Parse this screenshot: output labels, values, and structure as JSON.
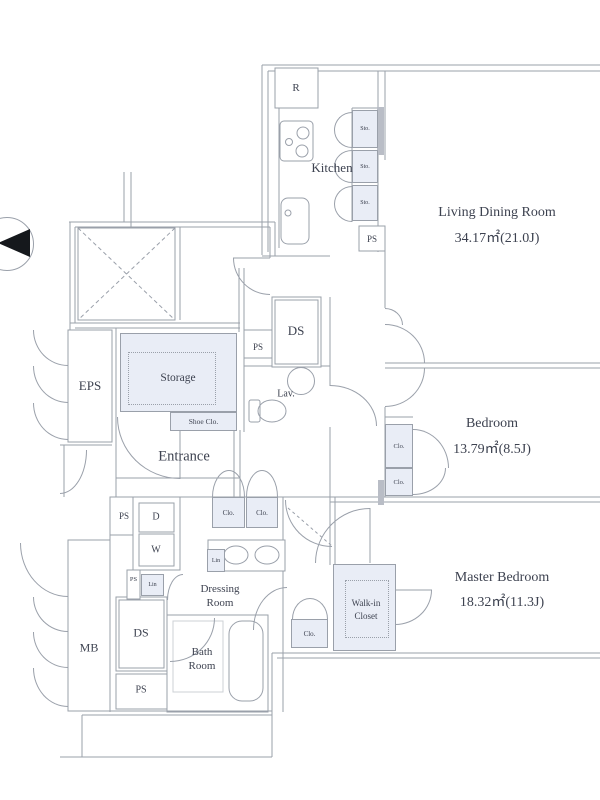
{
  "plan_type": "apartment floor plan",
  "rooms": {
    "living_dining": {
      "name": "Living Dining Room",
      "area": "34.17㎡(21.0J)"
    },
    "bedroom": {
      "name": "Bedroom",
      "area": "13.79㎡(8.5J)"
    },
    "master_bedroom": {
      "name": "Master Bedroom",
      "area": "18.32㎡(11.3J)"
    },
    "kitchen": {
      "name": "Kitchen"
    },
    "entrance": {
      "name": "Entrance"
    },
    "storage": {
      "name": "Storage"
    },
    "eps": {
      "name": "EPS"
    },
    "lavatory": {
      "name": "Lav."
    },
    "meter_box": {
      "name": "MB"
    },
    "dressing_room": {
      "line1": "Dressing",
      "line2": "Room"
    },
    "bath_room": {
      "line1": "Bath",
      "line2": "Room"
    },
    "walk_in_closet": {
      "line1": "Walk-in",
      "line2": "Closet"
    }
  },
  "fixtures": {
    "refrigerator": "R",
    "small_storage": "Sto.",
    "pipe_space": "PS",
    "duct_space": "DS",
    "closet": "Clo.",
    "shoe_closet": "Shoe Clo.",
    "linen": "Lin",
    "dryer": "D",
    "washer": "W"
  },
  "colors": {
    "wall_line": "#9aa0aa",
    "shade_fill": "#e9edf6",
    "text": "#3d4250",
    "wall_dark": "#b9bdc6",
    "north_marker": "#15181c"
  }
}
